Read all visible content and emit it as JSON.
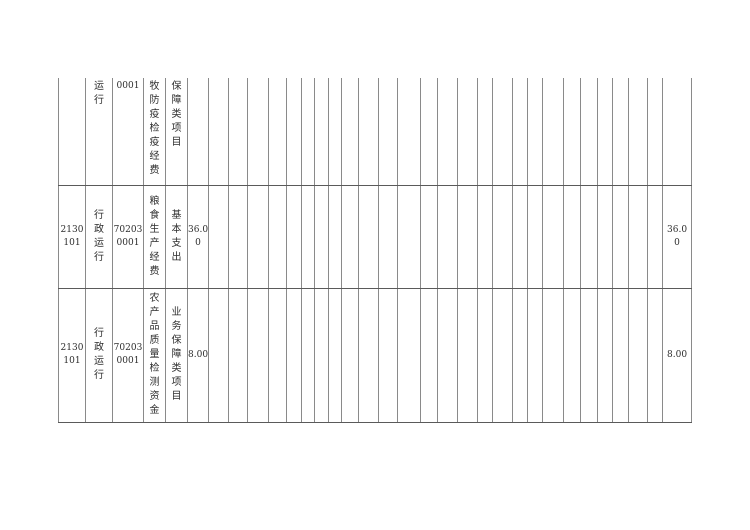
{
  "page": {
    "background_color": "#ffffff",
    "description_colors": {
      "border_vertical": "#8a8a8a",
      "border_horizontal": "#5a5a5a",
      "text": "#2e2e2e"
    }
  },
  "table": {
    "rows": [
      {
        "note": "row cut off at top of page, continuation of previous page row",
        "cells": {
          "code_a": "",
          "code_a_display": "",
          "unit_name": "运行",
          "code_b": "0001",
          "code_b_display": "0001",
          "project_name": "牧防疫检疫经费",
          "project_category": "保障类项目",
          "amount": "",
          "amount_display": "",
          "amount_total": "",
          "amount_total_display": ""
        }
      },
      {
        "cells": {
          "code_a": "2130101",
          "code_a_display": "2130\n101",
          "unit_name": "行政运行",
          "code_b": "702030001",
          "code_b_display": "70203\n0001",
          "project_name": "粮食生产经费",
          "project_category": "基本支出",
          "amount": "36.00",
          "amount_display": "36.0\n0",
          "amount_total": "36.00",
          "amount_total_display": "36.0\n0"
        }
      },
      {
        "cells": {
          "code_a": "2130101",
          "code_a_display": "2130\n101",
          "unit_name": "行政运行",
          "code_b": "702030001",
          "code_b_display": "70203\n0001",
          "project_name": "农产品质量检测资金",
          "project_category": "业务保障类项目",
          "amount": "8.00",
          "amount_display": "8.00",
          "amount_total": "8.00",
          "amount_total_display": "8.00"
        }
      }
    ]
  }
}
